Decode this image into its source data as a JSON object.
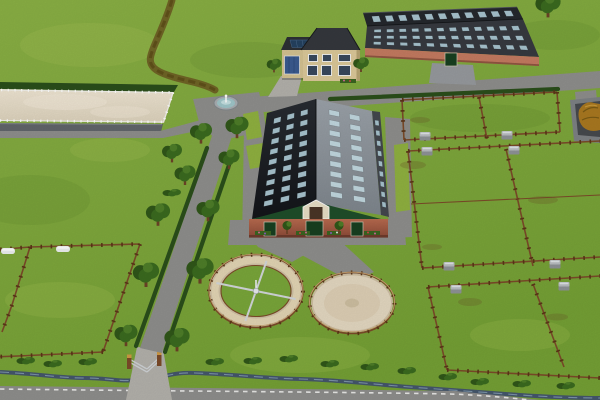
{
  "meta": {
    "app": "horse-farm-simulation-game",
    "view": "aerial-farm-overview",
    "width": 600,
    "height": 400
  },
  "scene": {
    "labels": {
      "ground": "Grass grounds",
      "arena": "Outdoor riding arena",
      "arena_hedge": "Hedge behind arena",
      "stable": "Large stable with skylight roof",
      "riding_hall": "Indoor riding hall",
      "farmhouse": "Farmhouse with garage",
      "fountain": "Fountain",
      "horse_walker": "Horse walker",
      "round_pen": "Round sand pen",
      "paddock_left": "West paddocks",
      "paddock_right": "East paddocks",
      "manure_heap": "Manure heap",
      "stream": "Stream",
      "main_road": "Farm road",
      "avenue": "Tree-lined lane",
      "bottom_road": "Public road",
      "driveway": "Gravel driveway",
      "gate": "Entrance gate",
      "dirt_path": "Worn dirt trail",
      "feeder": "Feeding trough",
      "tree": "Tree",
      "bush": "Bush"
    }
  },
  "palette": {
    "grass": "#7fa93c",
    "grassLight": "#b5cc60",
    "grassDark": "#4f7a22",
    "road": "#8e8e8c",
    "roadLight": "#b3b1ab",
    "sand": "#e9dfca",
    "sandDark": "#cfc0a4",
    "hedge": "#2a4e1a",
    "fence": "#7b4a28",
    "fencePost": "#5a3417",
    "fenceLight": "#c9a472",
    "fenceWhite": "#f4f3ee",
    "dirtPath": "#6d5c22",
    "stream": "#44566b",
    "streamHi": "#8aa2b8",
    "roofDark": "#1c1f24",
    "roofGray": "#939aa1",
    "roofSide": "#43474d",
    "roofHall": "#36393f",
    "roofHallBack": "#24272c",
    "skylight": "#a7c3ce",
    "skylightBright": "#c2d8e0",
    "brick": "#b5674d",
    "brickDark": "#8c4a37",
    "gable": "#1e4d29",
    "dormer": "#e8dfc6",
    "doorGreen": "#173f1f",
    "wallBeige": "#dcc999",
    "garageBlue": "#3a5a8f",
    "solar": "#24415f",
    "houseRoof": "#34373c",
    "water": "#9fc6c9",
    "basin": "#a9aeb2",
    "treeDark": "#2f5618",
    "treeMid": "#3a6a1e",
    "treeLight": "#4d7d28",
    "trunk": "#6b4226",
    "manure": "#a9781f",
    "manurePad": "#46494d",
    "feeder": "#b9bdc1",
    "roadDash": "#e8e8e6",
    "walkerArm": "#d3d7da"
  }
}
